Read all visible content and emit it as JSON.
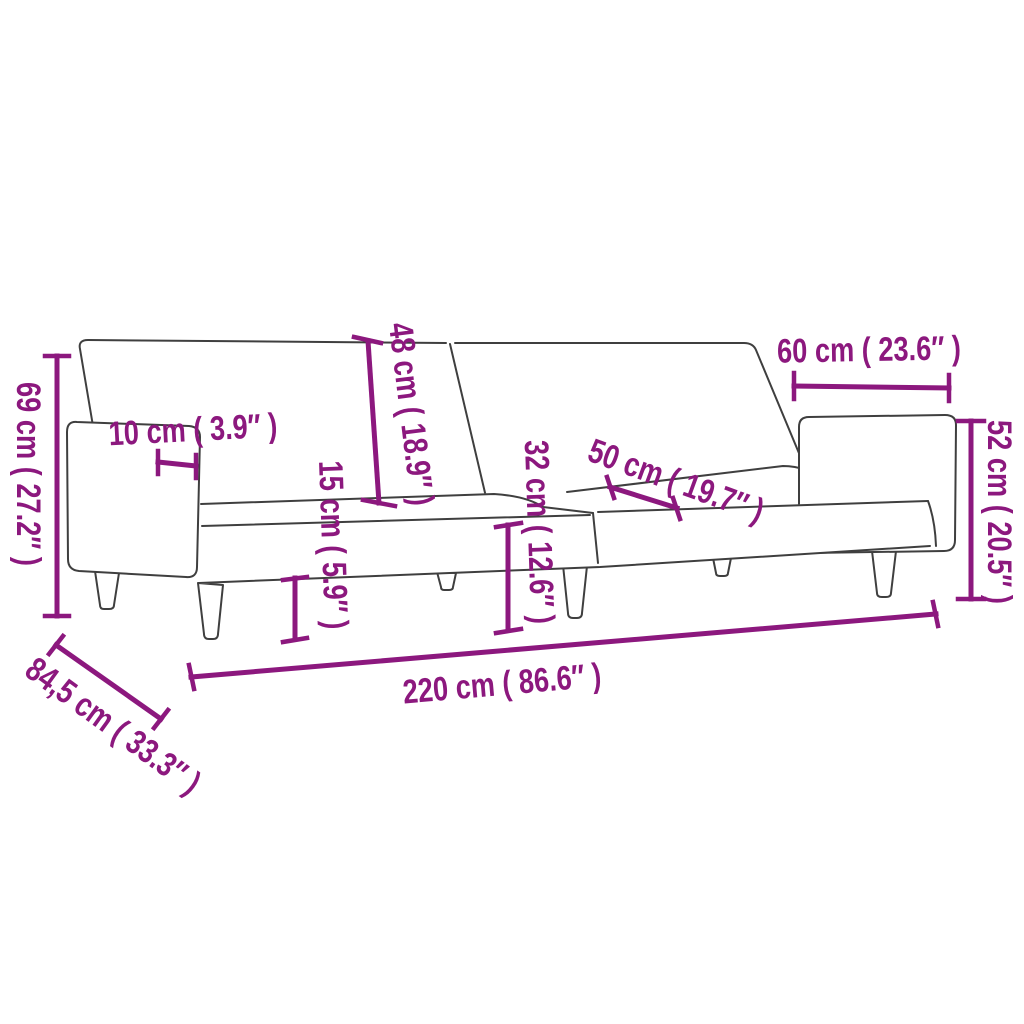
{
  "diagram": {
    "subject": "sofa-bed",
    "accent_color": "#8C187E",
    "outline_color": "#3F3F3F",
    "background_color": "#FFFFFF",
    "dimensions": [
      {
        "id": "overall-height",
        "label": "69 cm ( 27.2″ )",
        "value_cm": "69",
        "value_inch": "27.2"
      },
      {
        "id": "armrest-width",
        "label": "10 cm ( 3.9″ )",
        "value_cm": "10",
        "value_inch": "3.9"
      },
      {
        "id": "backrest-height",
        "label": "48 cm ( 18.9″ )",
        "value_cm": "48",
        "value_inch": "18.9"
      },
      {
        "id": "ground-clearance",
        "label": "15 cm ( 5.9″ )",
        "value_cm": "15",
        "value_inch": "5.9"
      },
      {
        "id": "seat-height",
        "label": "32 cm ( 12.6″ )",
        "value_cm": "32",
        "value_inch": "12.6"
      },
      {
        "id": "seat-depth",
        "label": "50 cm ( 19.7″ )",
        "value_cm": "50",
        "value_inch": "19.7"
      },
      {
        "id": "backrest-section-width",
        "label": "60 cm ( 23.6″ )",
        "value_cm": "60",
        "value_inch": "23.6"
      },
      {
        "id": "folded-armrest-height",
        "label": "52 cm ( 20.5″ )",
        "value_cm": "52",
        "value_inch": "20.5"
      },
      {
        "id": "overall-width",
        "label": "220 cm ( 86.6″ )",
        "value_cm": "220",
        "value_inch": "86.6"
      },
      {
        "id": "overall-depth",
        "label": "84,5 cm ( 33.3″ )",
        "value_cm": "84,5",
        "value_inch": "33.3"
      }
    ]
  }
}
